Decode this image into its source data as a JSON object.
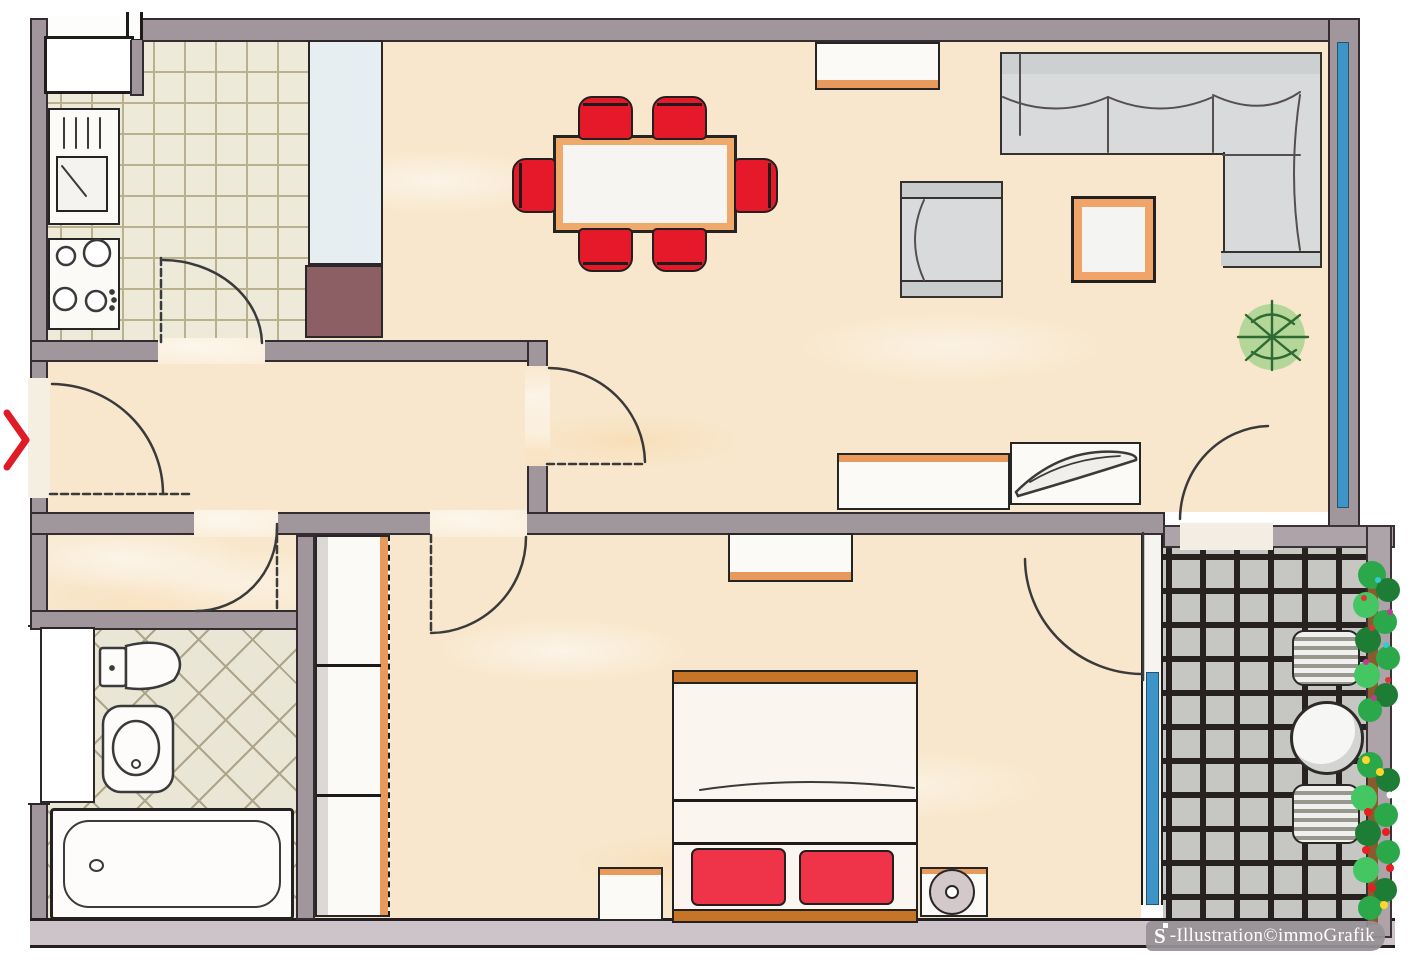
{
  "watermark": {
    "logo_letter": "S",
    "text": "-Illustration©immoGrafik"
  },
  "entrance_marker": {
    "type": "chevron-right",
    "color": "#e01b28"
  },
  "palette": {
    "wall": "#a2969d",
    "wall_light": "#ada3a9",
    "wall_bottom": "#ccc4c8",
    "floor_cream": "#f8e7cc",
    "kitchen_tile": "#eeead9",
    "kitchen_grout": "#b9b08e",
    "bath_tile": "#eae6d5",
    "balcony_tile": "#c6c7c3",
    "balcony_grout": "#27221f",
    "accent_red": "#e6192b",
    "pillow_red": "#ef3348",
    "wood_orange": "#e89a5c",
    "bed_frame_orange": "#c77427",
    "glass_blue": "#3d95c7",
    "furniture_gray": "#d9dadb",
    "shaft_brown": "#8c5f64",
    "cabinet_paleblue": "#e7eef1",
    "plant_green": "#2e7d32",
    "sketch_line": "#3a3a3a"
  },
  "floorplan": {
    "rooms": [
      {
        "name": "kitchen",
        "floor": "beige square tiles",
        "furniture": [
          "sink unit with drainer",
          "stove 4 burners",
          "corner cabinet",
          "tall cabinet column",
          "shaft"
        ]
      },
      {
        "name": "living-dining",
        "floor": "cream",
        "furniture": [
          "dining table with 6 red chairs",
          "sideboard",
          "corner sofa L-shape",
          "armchair",
          "coffee table",
          "potted plant",
          "tv lowboard",
          "lowboard with decor paddle"
        ]
      },
      {
        "name": "hallway",
        "floor": "cream",
        "furniture": []
      },
      {
        "name": "vestibule",
        "floor": "cream",
        "furniture": [
          "wardrobe"
        ]
      },
      {
        "name": "bathroom",
        "floor": "diagonal beige tiles",
        "furniture": [
          "toilet",
          "washbasin",
          "bathtub",
          "window column"
        ]
      },
      {
        "name": "bedroom",
        "floor": "cream",
        "furniture": [
          "wardrobe 3 sections",
          "dresser",
          "double bed with 2 red pillows",
          "nightstand left",
          "nightstand right with lamp"
        ]
      },
      {
        "name": "balcony",
        "floor": "dark grid tiles",
        "furniture": [
          "round table",
          "2 striped chairs",
          "flower boxes"
        ]
      }
    ],
    "doors": [
      "entrance (left wall, red arrow)",
      "kitchen-hall",
      "hall-living",
      "vestibule",
      "bedroom",
      "living-balcony glass",
      "bedroom-balcony glass"
    ],
    "windows": [
      "living room right wall (blue band)",
      "bathroom left wall",
      "bedroom-balcony glass partition"
    ]
  }
}
